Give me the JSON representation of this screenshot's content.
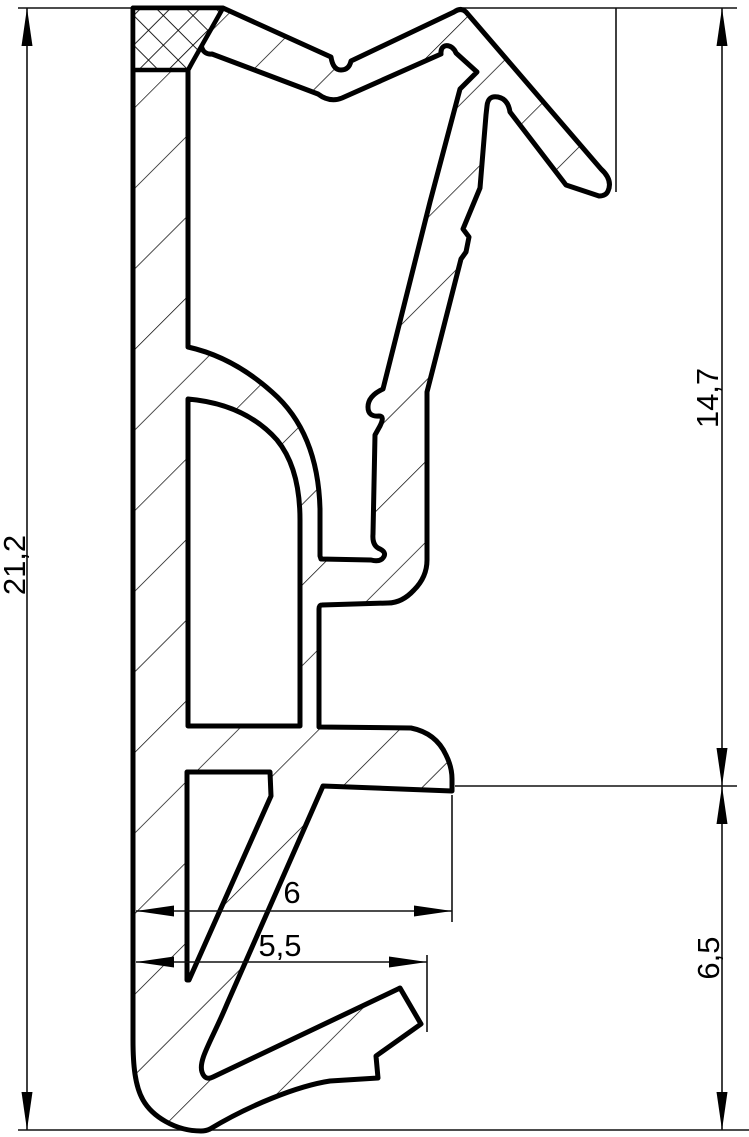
{
  "drawing": {
    "kind": "technical-cross-section-profile",
    "colors": {
      "background": "#ffffff",
      "line": "#000000"
    },
    "dimensions": [
      {
        "id": "overall-height",
        "label": "21,2",
        "orientation": "vertical",
        "side": "left"
      },
      {
        "id": "upper-section-height",
        "label": "14,7",
        "orientation": "vertical",
        "side": "right"
      },
      {
        "id": "lower-section-height",
        "label": "6,5",
        "orientation": "vertical",
        "side": "right"
      },
      {
        "id": "foot-width",
        "label": "6",
        "orientation": "horizontal",
        "side": "bottom"
      },
      {
        "id": "lip-width",
        "label": "5,5",
        "orientation": "horizontal",
        "side": "bottom"
      }
    ]
  }
}
